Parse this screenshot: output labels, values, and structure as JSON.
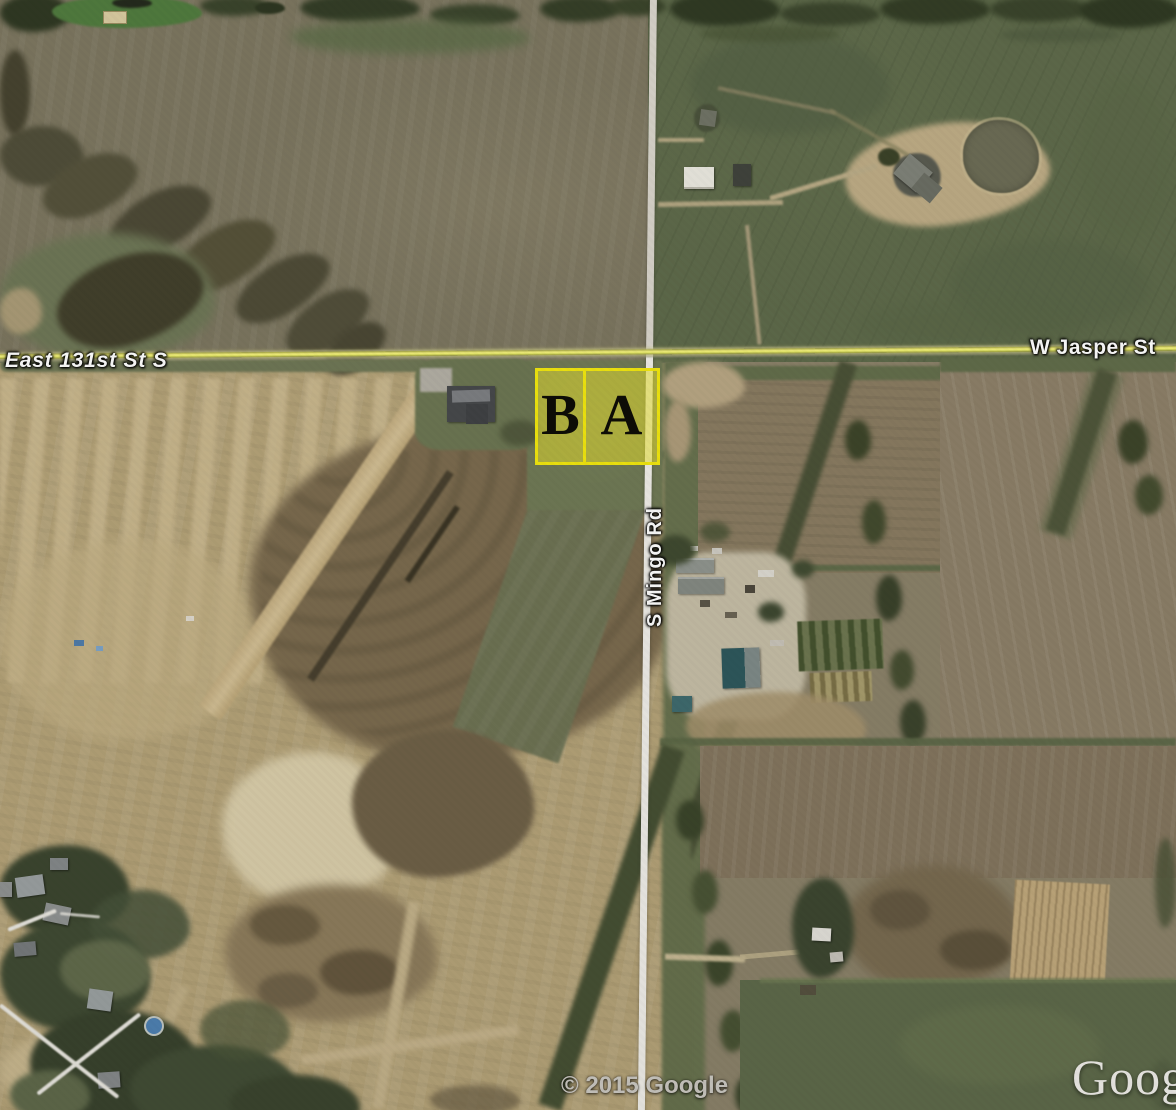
{
  "map": {
    "type": "satellite-imagery",
    "roads": {
      "east_131st_label": "East 131st St S",
      "w_jasper_label": "W Jasper St",
      "s_mingo_label": "S Mingo Rd"
    },
    "parcels": [
      {
        "label": "B"
      },
      {
        "label": "A"
      }
    ],
    "attribution": {
      "copyright": "© 2015 Google",
      "watermark": "Google"
    },
    "colors": {
      "road_yellow": "#f2ee6e",
      "road_white": "#eceae4",
      "parcel_border": "#f2e70e",
      "parcel_fill": "rgba(233,226,48,0.55)",
      "parcel_letter": "#0c0b05",
      "pasture_green": "#5d694a",
      "field_olive": "#7b755f",
      "field_brown": "#897b61",
      "dirt_tan": "#b4a278",
      "tree_dark": "#3a442c",
      "label_text": "#ffffff"
    }
  }
}
